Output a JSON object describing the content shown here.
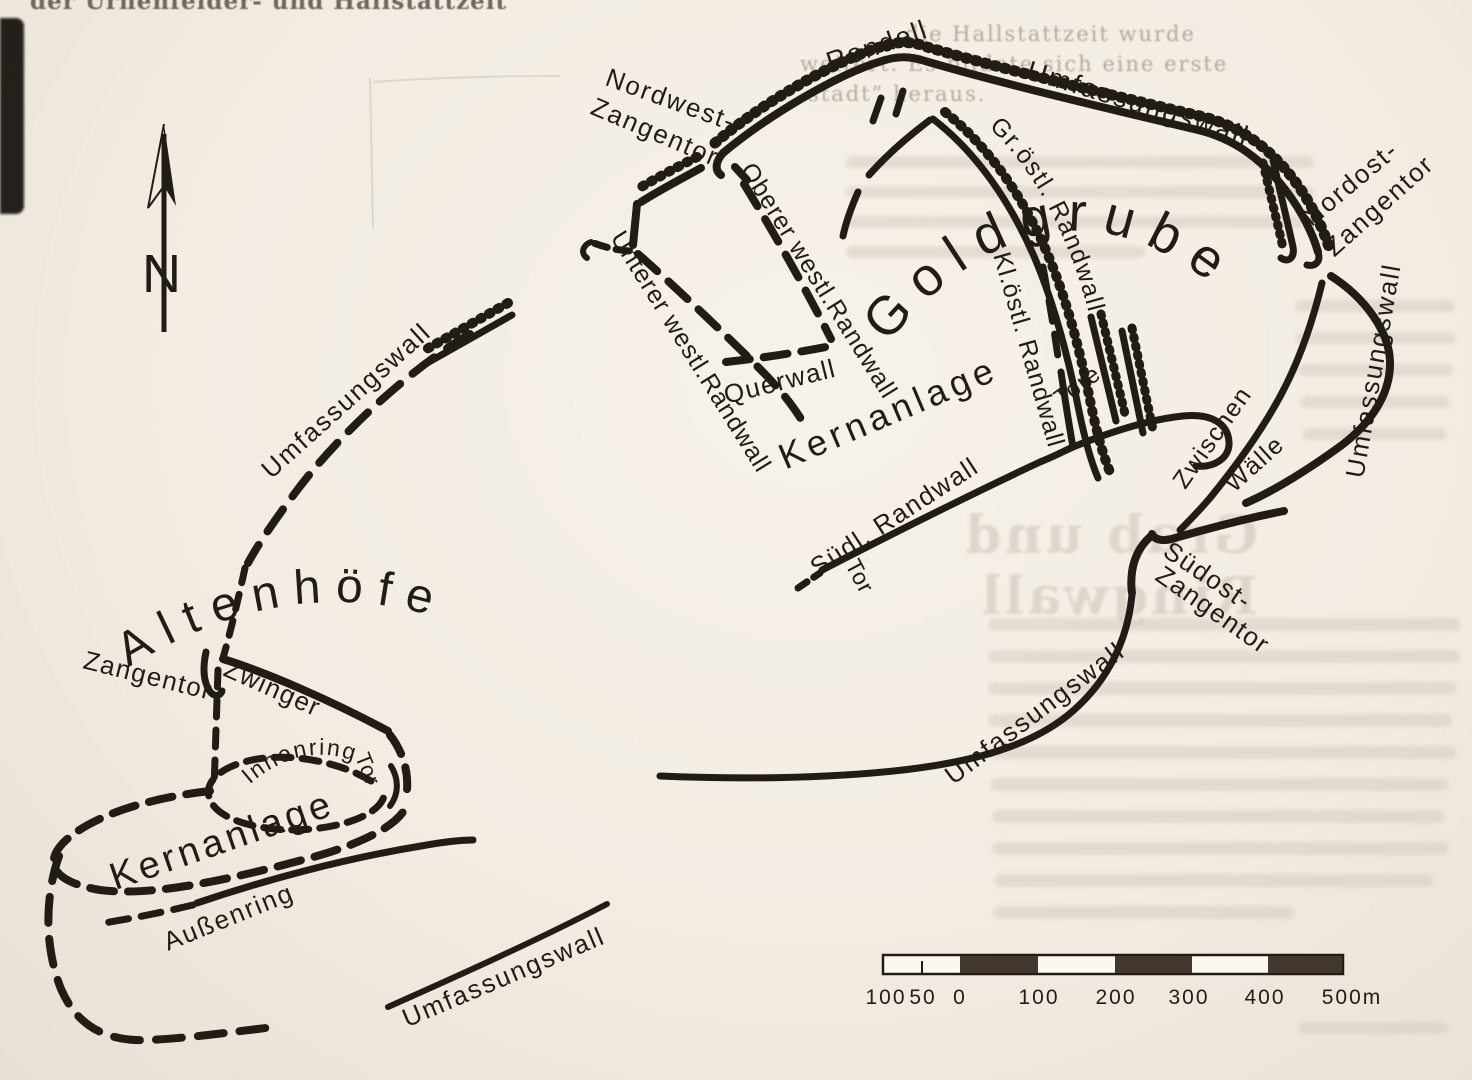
{
  "map": {
    "north_indicator": "N",
    "altenhoefe": {
      "title": "Altenhöfe",
      "labels": {
        "umfassungswall_nw": "Umfassungswall",
        "zangentor": "Zangentor",
        "zwinger": "Zwinger",
        "innenring": "Innenring",
        "tor": "Tor",
        "kernanlage": "Kernanlage",
        "aussenring": "Außenring",
        "umfassungswall_sw": "Umfassungswall"
      }
    },
    "goldgrube": {
      "title": "Goldgrube",
      "labels": {
        "rondell": "Rondell",
        "nordwest_zangentor_1": "Nordwest-",
        "nordwest_zangentor_2": "Zangentor",
        "umfassungswall_nord": "Umfassungswall",
        "oberer_westl_randwall": "Oberer westl.Randwall",
        "unterer_westl_randwall": "Unterer westl.Randwall",
        "querwall": "Querwall",
        "gr_oestl_randwall": "Gr.östl. Randwall",
        "kl_oestl_randwall": "Kl.östl. Randwall",
        "tore": "Tore",
        "kernanlage": "Kernanlage",
        "nordost_zangentor_1": "Nordost-",
        "nordost_zangentor_2": "Zangentor",
        "umfassungswall_ost": "Umfassungswall",
        "zwischen_waelle_1": "Zwischen",
        "zwischen_waelle_2": "Wälle",
        "suedl_randwall": "Südl. Randwall",
        "tor": "Tor",
        "suedost_zangentor_1": "Südost-",
        "suedost_zangentor_2": "Zangentor",
        "umfassungswall_suedost": "Umfassungswall"
      }
    },
    "scale_bar": {
      "ticks": [
        "100",
        "50",
        "0",
        "100",
        "200",
        "300",
        "400",
        "500m"
      ]
    },
    "colors": {
      "ink": "#221c16",
      "paper": "#f2ece3",
      "scale_dark": "#42382e"
    }
  },
  "bleed_through": {
    "top_left_fragment": "der Urnenfelder- und Hallstattzeit",
    "right_col_line_1": "die Hallstattzeit wurde",
    "right_col_line_2": "weitert. Es bildete sich eine erste",
    "right_col_line_3": "stadt” heraus.",
    "mirrored_heading": "Grab und Ringwall"
  }
}
